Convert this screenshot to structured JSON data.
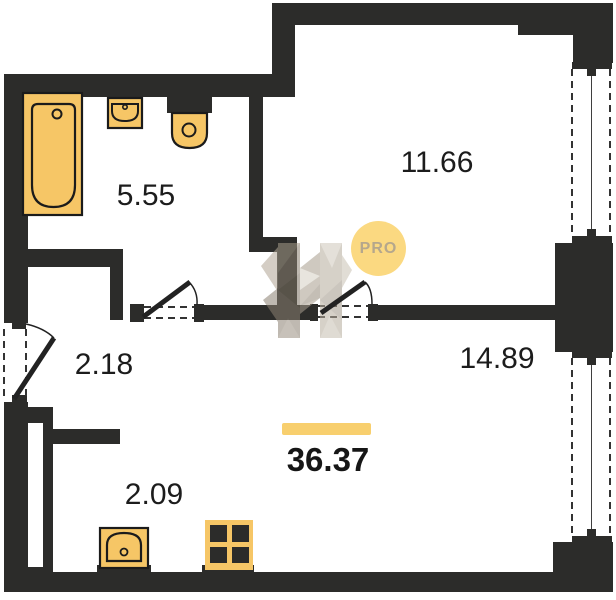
{
  "rooms": {
    "bathroom": {
      "area": "5.55"
    },
    "bedroom": {
      "area": "11.66"
    },
    "hallway": {
      "area": "2.18"
    },
    "living": {
      "area": "14.89"
    },
    "kitchen": {
      "area": "2.09"
    }
  },
  "total": {
    "area": "36.37"
  },
  "watermark": {
    "badge_label": "PRO"
  },
  "colors": {
    "wall": "#2c2c2a",
    "fixture_fill": "#f6c666",
    "accent_bar": "#f8cf6e",
    "pro_badge_bg": "#fbd981",
    "pro_badge_text": "#b5a78c",
    "label_text": "#1c1c1c"
  }
}
